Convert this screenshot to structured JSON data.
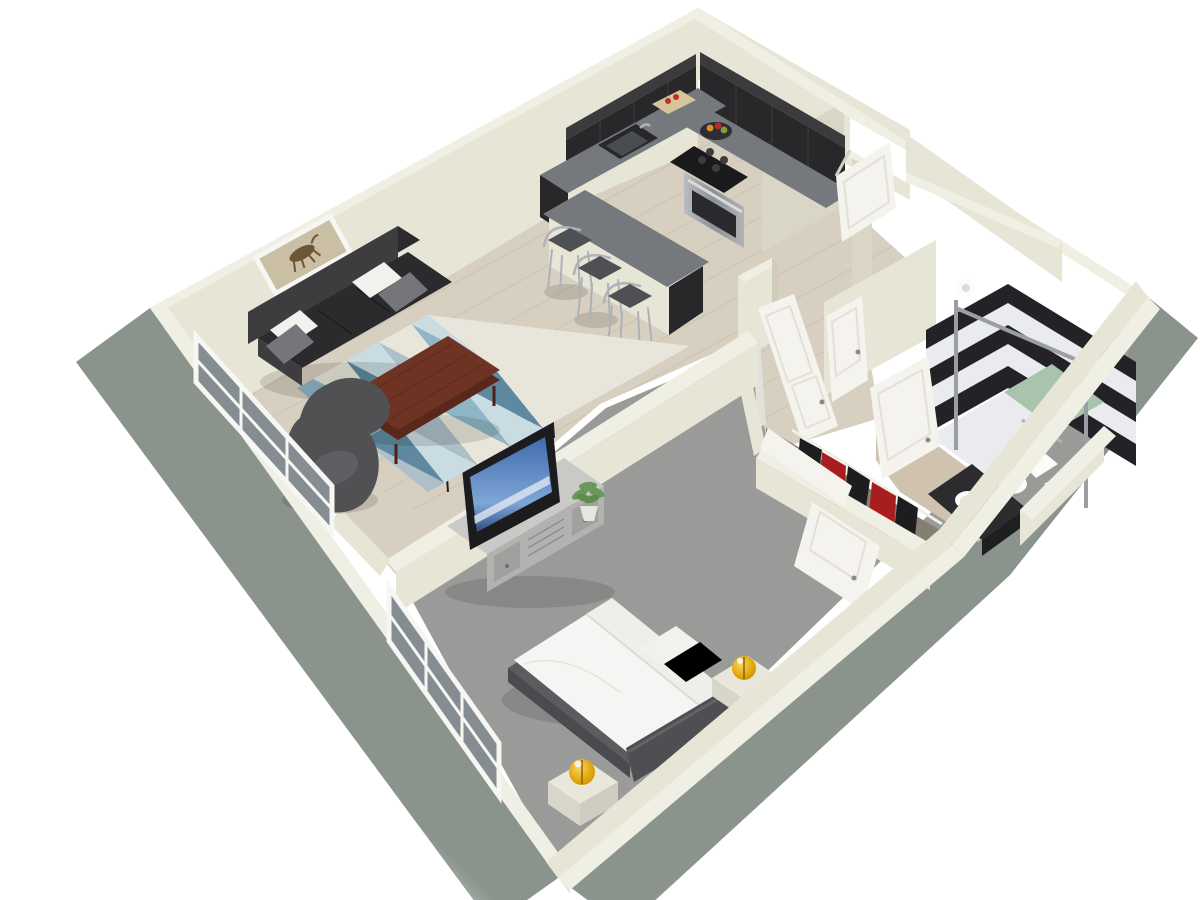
{
  "scene": {
    "kind": "3d-floor-plan-render",
    "view": "isometric overhead",
    "unit_type": "one-bedroom apartment",
    "background": "#ffffff"
  },
  "colors": {
    "bg": "#ffffff",
    "exterior": "#8a938c",
    "exterior_fade": "#c3c8c2",
    "wall_top": "#f0efe3",
    "wall_face": "#e7e5d6",
    "wall_shadow": "#d9d6c6",
    "wall_dark": "#cfccbc",
    "wood": "#d7cfc0",
    "wood_line": "#c4baa8",
    "carpet": "#9c9c9a",
    "bath_floor": "#cfc2ae",
    "cabinet": "#28282a",
    "cabinet_light": "#3b3b3d",
    "counter": "#75787c",
    "steel": "#aeb2b6",
    "sofa": "#2b2b2d",
    "sofa_light": "#3d3d40",
    "pillow_white": "#f1f1ed",
    "pillow_gray": "#76767a",
    "table": "#6e3323",
    "table_dark": "#59281b",
    "rug_blue": "#8fb6c6",
    "rug_teal": "#5e89a0",
    "rug_pale": "#c9dce2",
    "rug_cream": "#e8e6da",
    "rug_gray": "#aebfc7",
    "chair": "#515154",
    "bed_white": "#f5f5f3",
    "bed_frame": "#5b5c60",
    "headboard": "#4e4f53",
    "nightstand": "#e9e7dc",
    "lamp": "#e2a90e",
    "lamp_deep": "#b8860b",
    "door": "#f4f3ee",
    "door_shadow": "#e2e0d8",
    "glass": "#858d92",
    "window_frame": "#f6f6f3",
    "shower_dark": "#232327",
    "shower_light": "#e9ebee",
    "shower_green": "#a9c3ad",
    "vanity": "#2c2c2e",
    "porcelain": "#fbfbf9",
    "clothes_red": "#a81e1e",
    "clothes_dark": "#1d1d1f",
    "tv": "#1c1c1e",
    "screen_blue": "#3f6cae",
    "plant": "#69985c",
    "art_bg": "#cabfa4",
    "horse": "#6b5636"
  },
  "rooms": [
    {
      "name": "living-room",
      "floor": "light hardwood",
      "furniture": [
        "black-leather-sofa",
        "white-pillows",
        "gray-pillows",
        "geometric-area-rug",
        "wood-coffee-table",
        "gray-egg-chair",
        "horse-wall-art",
        "black-console-table",
        "window-wall"
      ]
    },
    {
      "name": "kitchen",
      "floor": "light hardwood",
      "furniture": [
        "dark-upper-cabinets",
        "dark-base-cabinets",
        "gray-countertop",
        "black-sink",
        "gas-range-oven",
        "fruit-bowl",
        "cutting-board",
        "breakfast-bar",
        "bar-stool",
        "bar-stool",
        "bar-stool"
      ]
    },
    {
      "name": "entry-hall",
      "floor": "light hardwood",
      "furniture": [
        "entry-door-open",
        "utility-door-closed",
        "bathroom-door-open",
        "bedroom-door-open"
      ]
    },
    {
      "name": "utility-closet",
      "floor": "hardwood",
      "furniture": [
        "round-fixture"
      ]
    },
    {
      "name": "bathroom",
      "floor": "beige tile",
      "furniture": [
        "striped-shower-walls",
        "glass-shower-frame",
        "shower-floor-green-white",
        "towel-bar",
        "toilet",
        "black-vanity",
        "round-white-sink"
      ]
    },
    {
      "name": "closet",
      "floor": "carpet",
      "furniture": [
        "clothes-rail",
        "red-garments",
        "black-garments",
        "open-closet-doors"
      ]
    },
    {
      "name": "bedroom",
      "floor": "gray carpet",
      "furniture": [
        "platform-bed-white-bedding",
        "dark-headboard",
        "nightstand",
        "nightstand",
        "amber-lamp",
        "amber-lamp",
        "tv-stand",
        "flat-screen-tv",
        "potted-plant",
        "window-wall"
      ]
    }
  ]
}
